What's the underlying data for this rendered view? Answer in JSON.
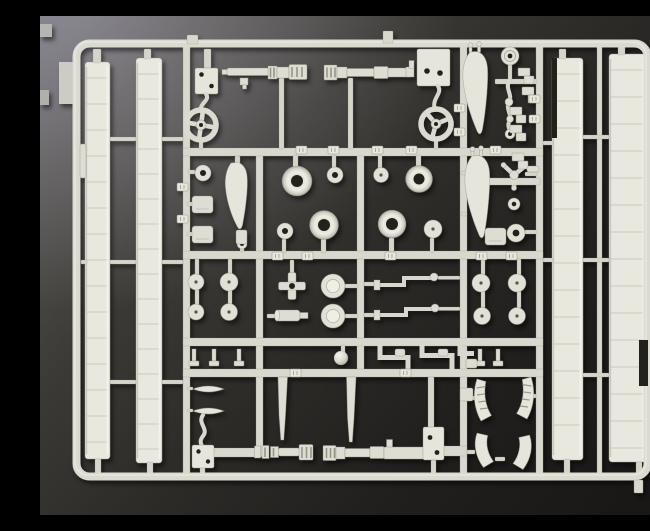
{
  "scene": {
    "subject": "Photograph of a light ivory injection-molded plastic model kit parts sprue on a dark gradient background",
    "palette": {
      "plastic": "#dcdbd1",
      "plastic_light": "#eceade",
      "plastic_shadow": "#a8a79a",
      "background_light": "#6f6e76",
      "background_dark": "#161514",
      "hole_dark": "#24231f"
    },
    "parts_inventory": [
      "outer sprue frame with rounded corners",
      "four long wing strip parts with panel lines",
      "four machine-gun barrel assemblies",
      "four rectangular mounting plates with locating holes",
      "cross-spoke control wheel",
      "three-spoke control wheel",
      "three teardrop propeller-blade parts",
      "four tires and many hub discs",
      "levers, cylinders, brackets, step fittings",
      "four curved cowl shells, two louvered",
      "ball part and tripod strut"
    ]
  },
  "sprue": {
    "frame": {
      "x": 36.5,
      "y": 27.5,
      "w": 571,
      "h": 433,
      "rx": 13
    },
    "bars": {
      "main": [
        [
          143,
          30,
          7,
          428
        ],
        [
          216,
          133,
          7,
          300
        ],
        [
          317,
          133,
          7,
          225
        ],
        [
          420,
          30,
          7,
          428
        ],
        [
          496,
          30,
          7,
          428
        ],
        [
          557,
          30,
          5,
          428
        ],
        [
          143,
          132,
          360,
          8
        ],
        [
          143,
          235,
          360,
          8
        ],
        [
          143,
          322,
          360,
          8
        ],
        [
          143,
          353,
          360,
          8
        ],
        [
          443,
          162,
          57,
          7
        ],
        [
          398,
          430,
          29,
          10
        ],
        [
          172,
          432,
          50,
          9
        ]
      ],
      "thin": [
        [
          41,
          244,
          6,
          4
        ],
        [
          70,
          121,
          26,
          4
        ],
        [
          70,
          244,
          26,
          4
        ],
        [
          70,
          364,
          26,
          4
        ],
        [
          122,
          121,
          21,
          4
        ],
        [
          122,
          244,
          21,
          4
        ],
        [
          122,
          364,
          21,
          4
        ],
        [
          503,
          125,
          10,
          4
        ],
        [
          543,
          119,
          26,
          4
        ],
        [
          503,
          242,
          10,
          4
        ],
        [
          543,
          242,
          26,
          4
        ],
        [
          543,
          357,
          26,
          4
        ],
        [
          148,
          154,
          7,
          4
        ],
        [
          147,
          186,
          6,
          4
        ],
        [
          147,
          216,
          6,
          4
        ],
        [
          485,
          156,
          12,
          4
        ],
        [
          485,
          214,
          12,
          4
        ],
        [
          455,
          63,
          42,
          5
        ],
        [
          147,
          371,
          6,
          3
        ],
        [
          147,
          393,
          6,
          3
        ],
        [
          324,
          266,
          16,
          4
        ],
        [
          324,
          297,
          16,
          4
        ],
        [
          398,
          260,
          22,
          3.5
        ],
        [
          398,
          291,
          22,
          3.5
        ],
        [
          227,
          298,
          10,
          4
        ],
        [
          305,
          268,
          13,
          4
        ],
        [
          305,
          298,
          13,
          4
        ],
        [
          427,
          380,
          8,
          4
        ],
        [
          427,
          434,
          8,
          4
        ],
        [
          455,
          441,
          10,
          4
        ],
        [
          488,
          378,
          8,
          4
        ],
        [
          421,
          155,
          6,
          4
        ],
        [
          421,
          196,
          6,
          4
        ],
        [
          53,
          33,
          8,
          14
        ],
        [
          104,
          33,
          7,
          10
        ],
        [
          519,
          33,
          7,
          10
        ],
        [
          578,
          31,
          7,
          8
        ],
        [
          55,
          443,
          6,
          15
        ],
        [
          107,
          446,
          6,
          12
        ],
        [
          524,
          443,
          6,
          15
        ],
        [
          596,
          446,
          6,
          14
        ],
        [
          239,
          62,
          5,
          71
        ],
        [
          308,
          62,
          5,
          71
        ],
        [
          159,
          123,
          4,
          10
        ],
        [
          394,
          122,
          4,
          11
        ],
        [
          164,
          33,
          7,
          19
        ],
        [
          195,
          140,
          5,
          8
        ],
        [
          253,
          139,
          5,
          13
        ],
        [
          376,
          139,
          5,
          12
        ],
        [
          292,
          139,
          4,
          13
        ],
        [
          338,
          139,
          4,
          14
        ],
        [
          281,
          223,
          5,
          14
        ],
        [
          349,
          222,
          5,
          14
        ],
        [
          242,
          223,
          4,
          14
        ],
        [
          390,
          222,
          4,
          15
        ],
        [
          250,
          244,
          4,
          13
        ],
        [
          301,
          329,
          4,
          8
        ],
        [
          155,
          243,
          4,
          16
        ],
        [
          188,
          243,
          4,
          16
        ],
        [
          155,
          273,
          4,
          16
        ],
        [
          188,
          273,
          4,
          16
        ],
        [
          441,
          243,
          4,
          16
        ],
        [
          477,
          243,
          4,
          16
        ],
        [
          441,
          275,
          4,
          17
        ],
        [
          477,
          275,
          4,
          17
        ],
        [
          468,
          30,
          4,
          6
        ],
        [
          468,
          48,
          4,
          16
        ],
        [
          391,
          444,
          5,
          14
        ],
        [
          160,
          451,
          5,
          8
        ],
        [
          200,
          230,
          4,
          6
        ],
        [
          388,
          361,
          6,
          52
        ]
      ]
    },
    "strips": [
      {
        "id": "wing-strip-far-left",
        "x": 45,
        "y": 46,
        "w": 25,
        "h": 397,
        "step": 26
      },
      {
        "id": "wing-strip-left",
        "x": 96,
        "y": 42,
        "w": 26,
        "h": 405,
        "step": 25
      },
      {
        "id": "wing-strip-right",
        "x": 512,
        "y": 42,
        "w": 31,
        "h": 402,
        "step": 27
      },
      {
        "id": "wing-strip-far-right",
        "x": 569,
        "y": 38,
        "w": 37,
        "h": 408,
        "step": 27
      }
    ],
    "notches": [
      [
        599,
        324,
        9,
        46
      ],
      [
        512,
        42,
        5,
        80
      ]
    ],
    "tires": [
      [
        257,
        165,
        15,
        6
      ],
      [
        379,
        163,
        13.5,
        5.5
      ],
      [
        284,
        209,
        14.5,
        6
      ],
      [
        352,
        208,
        14,
        6
      ]
    ],
    "discs": [
      [
        295,
        159,
        8,
        "hole"
      ],
      [
        341,
        159,
        7.5,
        "dot"
      ],
      [
        245,
        215,
        8,
        "hole"
      ],
      [
        393,
        213,
        9,
        "dot"
      ],
      [
        163,
        157,
        8,
        "hole"
      ],
      [
        474,
        188,
        6,
        "hole"
      ],
      [
        476,
        217,
        9,
        "hole"
      ],
      [
        156,
        266,
        8,
        "dot"
      ],
      [
        189,
        266,
        9,
        "dot"
      ],
      [
        156,
        296,
        8,
        "dot"
      ],
      [
        189,
        296,
        8.5,
        "dot"
      ],
      [
        441,
        267,
        9,
        "dot"
      ],
      [
        477,
        267,
        9,
        "dot"
      ],
      [
        442,
        300,
        8.5,
        "dot"
      ],
      [
        477,
        300,
        8.5,
        "dot"
      ],
      [
        293,
        270,
        12,
        "boss"
      ],
      [
        293,
        300,
        12,
        "boss"
      ],
      [
        470,
        40,
        9,
        "ring"
      ],
      [
        301,
        342,
        7,
        "ball"
      ],
      [
        202,
        228,
        5,
        "hole"
      ],
      [
        470,
        118,
        5,
        "hole"
      ],
      [
        469,
        86,
        4,
        "plain"
      ],
      [
        470,
        103,
        3.5,
        "plain"
      ]
    ],
    "number_tabs": [
      [
        256,
        130
      ],
      [
        288,
        130
      ],
      [
        332,
        130
      ],
      [
        366,
        130
      ],
      [
        450,
        130
      ],
      [
        232,
        236
      ],
      [
        262,
        236
      ],
      [
        345,
        236
      ],
      [
        436,
        236
      ],
      [
        466,
        236
      ],
      [
        137,
        167
      ],
      [
        137,
        199
      ],
      [
        250,
        353
      ],
      [
        360,
        353
      ],
      [
        489,
        79
      ],
      [
        489,
        99
      ],
      [
        414,
        88
      ],
      [
        414,
        112
      ]
    ],
    "small": {
      "steps": [
        [
          478,
          52
        ],
        [
          482,
          71
        ],
        [
          470,
          91
        ],
        [
          470,
          109
        ],
        [
          472,
          137
        ]
      ],
      "tstubs": [
        [
          152,
          333
        ],
        [
          172,
          333
        ],
        [
          197,
          333
        ],
        [
          438,
          333
        ],
        [
          456,
          333
        ]
      ],
      "leaves": [
        [
          153,
          373
        ],
        [
          153,
          395
        ]
      ],
      "wedges": [
        [
          152,
          180
        ],
        [
          152,
          210
        ],
        [
          445,
          212
        ]
      ],
      "clips": [
        [
          40,
          128,
          6,
          34
        ],
        [
          420,
          372,
          13,
          13
        ],
        [
          426,
          343,
          11,
          9
        ],
        [
          355,
          333,
          10,
          7
        ],
        [
          398,
          333,
          10,
          7
        ],
        [
          487,
          150,
          12,
          6
        ],
        [
          196,
          214,
          11,
          14
        ]
      ]
    },
    "stubs": [
      [
        147,
        19,
        11,
        9
      ],
      [
        343,
        15,
        10,
        12
      ],
      [
        594,
        464,
        9,
        13
      ]
    ],
    "artifacts": [
      [
        0,
        8,
        12,
        13,
        "#b6b5b1"
      ],
      [
        0,
        74,
        9,
        15,
        "#b0afab"
      ],
      [
        19,
        46,
        14,
        42,
        "#cdccc4"
      ]
    ]
  }
}
